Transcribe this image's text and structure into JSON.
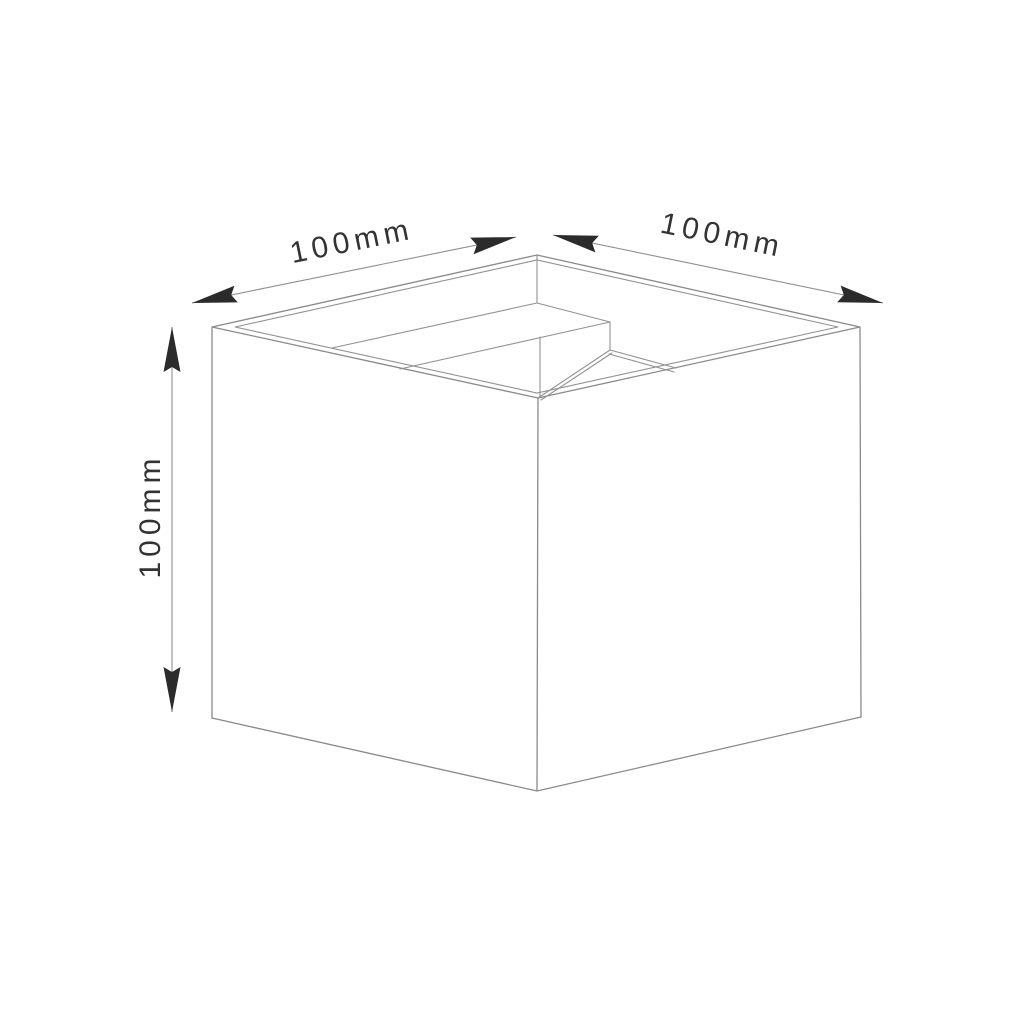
{
  "drawing": {
    "object": "cube-luminaire-technical-drawing",
    "view": "isometric",
    "dimension_labels": {
      "top_left": "100mm",
      "top_right": "100mm",
      "height": "100mm"
    },
    "dimensions_mm": {
      "width": 100,
      "depth": 100,
      "height": 100
    },
    "colors": {
      "background": "#ffffff",
      "edge_line": "#8a8a8a",
      "dimension_line": "#8f8f8f",
      "arrowhead": "#2b2b2b",
      "label_text": "#333333"
    }
  }
}
